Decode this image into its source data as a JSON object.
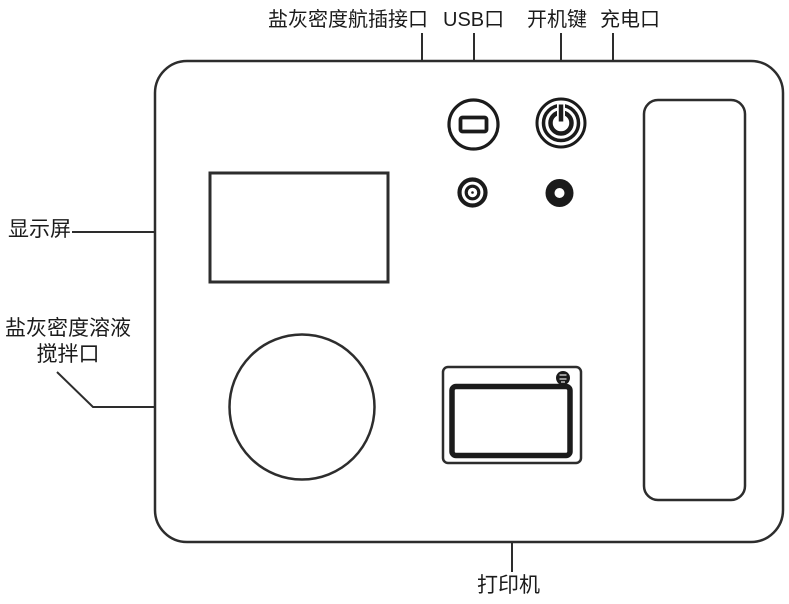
{
  "diagram": {
    "description": "labeled line drawing of a salt-ash density measuring instrument front panel",
    "labels": {
      "aviation_port": "盐灰密度航插接口",
      "usb_port": "USB口",
      "power_button": "开机键",
      "charge_port": "充电口",
      "display_screen": "显示屏",
      "stir_port_line1": "盐灰密度溶液",
      "stir_port_line2": "搅拌口",
      "printer": "打印机"
    },
    "icons": {
      "usb_port": "usb-port-icon",
      "power_button": "power-symbol-icon",
      "aviation_connector": "aviation-connector-icon",
      "charge_connector": "charge-connector-icon",
      "printer_screw": "screw-icon"
    },
    "colors": {
      "outline": "#2d2d2d",
      "dark": "#1b1b1b",
      "background": "#ffffff"
    }
  }
}
